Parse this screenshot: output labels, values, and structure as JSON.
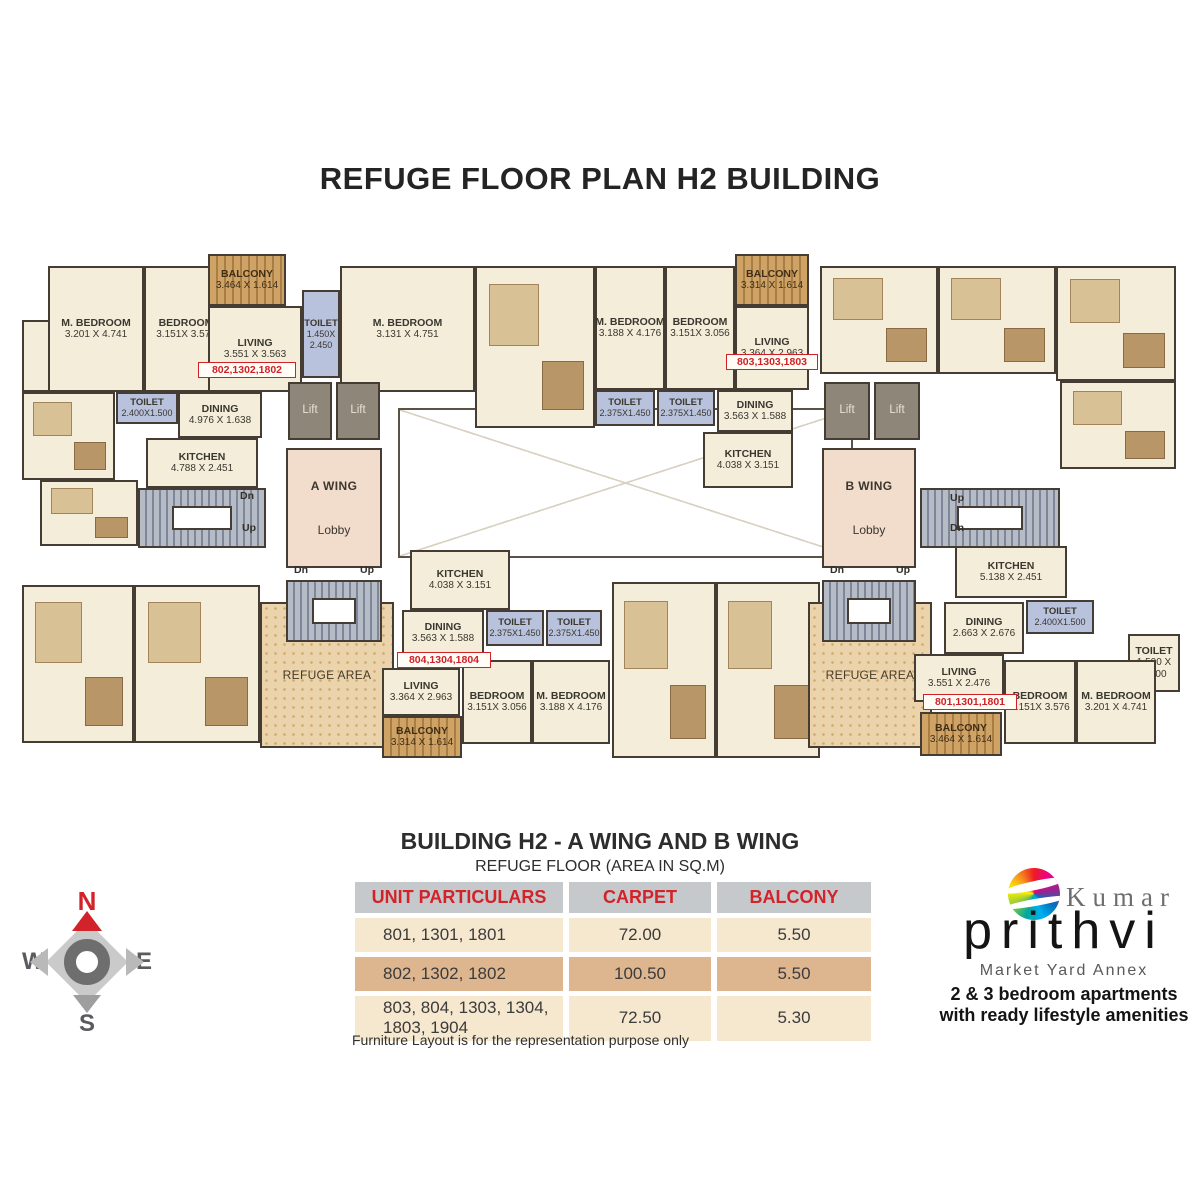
{
  "title": "REFUGE FLOOR PLAN H2 BUILDING",
  "colors": {
    "accent_red": "#d2232a",
    "wall_brown": "#453c33",
    "room_cream": "#f3edda",
    "toilet_blue": "#b9c2dc",
    "balcony_wood": "#c79b5e",
    "lobby_pink": "#f2dccb",
    "refuge_tan": "#ebd4ab",
    "lift_gray": "#8d8679",
    "table_header_gray": "#c6c9cc",
    "table_row_light": "#f6e7cf",
    "table_row_dark": "#ddb68f"
  },
  "plan": {
    "rooms": [
      {
        "id": "void-center",
        "type": "void",
        "lines": [],
        "x": 378,
        "y": 158,
        "w": 455,
        "h": 150
      },
      {
        "id": "block-top-center-left",
        "type": "furnished",
        "lines": [],
        "x": 455,
        "y": 16,
        "w": 120,
        "h": 162
      },
      {
        "id": "block-top-right-1",
        "type": "furnished",
        "lines": [],
        "x": 800,
        "y": 16,
        "w": 118,
        "h": 108
      },
      {
        "id": "block-top-right-2",
        "type": "furnished",
        "lines": [],
        "x": 918,
        "y": 16,
        "w": 118,
        "h": 108
      },
      {
        "id": "block-top-right-3",
        "type": "furnished",
        "lines": [],
        "x": 1036,
        "y": 16,
        "w": 120,
        "h": 115
      },
      {
        "id": "block-right-mid",
        "type": "furnished",
        "lines": [],
        "x": 1040,
        "y": 131,
        "w": 116,
        "h": 88
      },
      {
        "id": "block-bottom-left-1",
        "type": "furnished",
        "lines": [],
        "x": 2,
        "y": 335,
        "w": 112,
        "h": 158
      },
      {
        "id": "block-bottom-left-2",
        "type": "furnished",
        "lines": [],
        "x": 114,
        "y": 335,
        "w": 126,
        "h": 158
      },
      {
        "id": "block-left-entry",
        "type": "furnished",
        "lines": [],
        "x": 2,
        "y": 142,
        "w": 93,
        "h": 88
      },
      {
        "id": "block-left-of-stair",
        "type": "furnished",
        "lines": [],
        "x": 20,
        "y": 230,
        "w": 98,
        "h": 66
      },
      {
        "id": "block-bottom-center-1",
        "type": "furnished",
        "lines": [],
        "x": 592,
        "y": 332,
        "w": 104,
        "h": 176
      },
      {
        "id": "block-bottom-center-2",
        "type": "furnished",
        "lines": [],
        "x": 696,
        "y": 332,
        "w": 104,
        "h": 176
      },
      {
        "id": "toilet-entry-802",
        "type": "room",
        "lines": [
          "TOILET",
          "1.500 X",
          "2.400"
        ],
        "x": 2,
        "y": 70,
        "w": 93,
        "h": 72
      },
      {
        "id": "m-bedroom-802",
        "type": "room",
        "lines": [
          "M. BEDROOM",
          "3.201 X 4.741"
        ],
        "x": 28,
        "y": 16,
        "w": 96,
        "h": 126
      },
      {
        "id": "bedroom-802",
        "type": "room",
        "lines": [
          "BEDROOM",
          "3.151X 3.576"
        ],
        "x": 124,
        "y": 16,
        "w": 84,
        "h": 126
      },
      {
        "id": "balcony-802",
        "type": "balcony",
        "lines": [
          "BALCONY",
          "3.464 X 1.614"
        ],
        "x": 188,
        "y": 4,
        "w": 78,
        "h": 52
      },
      {
        "id": "living-802",
        "type": "room",
        "lines": [
          "LIVING",
          "3.551 X 3.563"
        ],
        "x": 188,
        "y": 56,
        "w": 94,
        "h": 86
      },
      {
        "id": "toilet-802-attached",
        "type": "toilet",
        "lines": [
          "TOILET",
          "1.450X",
          "2.450"
        ],
        "x": 282,
        "y": 40,
        "w": 38,
        "h": 88
      },
      {
        "id": "m-bedroom-802-second",
        "type": "room",
        "lines": [
          "M. BEDROOM",
          "3.131 X 4.751"
        ],
        "x": 320,
        "y": 16,
        "w": 135,
        "h": 126
      },
      {
        "id": "toilet-802-common",
        "type": "toilet",
        "lines": [
          "TOILET",
          "2.400X1.500"
        ],
        "x": 96,
        "y": 142,
        "w": 62,
        "h": 32
      },
      {
        "id": "dining-802",
        "type": "room",
        "lines": [
          "DINING",
          "4.976 X 1.638"
        ],
        "x": 158,
        "y": 142,
        "w": 84,
        "h": 46
      },
      {
        "id": "kitchen-802",
        "type": "room",
        "lines": [
          "KITCHEN",
          "4.788 X 2.451"
        ],
        "x": 126,
        "y": 188,
        "w": 112,
        "h": 50
      },
      {
        "id": "refuge-area-a",
        "type": "refuge",
        "lines": [
          "REFUGE AREA"
        ],
        "x": 240,
        "y": 352,
        "w": 134,
        "h": 146
      },
      {
        "id": "lift-a-1",
        "type": "lift",
        "lines": [
          "Lift"
        ],
        "x": 268,
        "y": 132,
        "w": 44,
        "h": 58
      },
      {
        "id": "lift-a-2",
        "type": "lift",
        "lines": [
          "Lift"
        ],
        "x": 316,
        "y": 132,
        "w": 44,
        "h": 58
      },
      {
        "id": "lobby-a-wing",
        "type": "lobby",
        "lines": [
          "A WING",
          "Lobby"
        ],
        "x": 266,
        "y": 198,
        "w": 96,
        "h": 120
      },
      {
        "id": "stair-a-left",
        "type": "stair",
        "lines": [],
        "x": 118,
        "y": 238,
        "w": 128,
        "h": 60
      },
      {
        "id": "stair-a-mid",
        "type": "stair",
        "lines": [],
        "x": 266,
        "y": 330,
        "w": 96,
        "h": 62
      },
      {
        "id": "m-bedroom-803",
        "type": "room",
        "lines": [
          "M. BEDROOM",
          "3.188 X 4.176"
        ],
        "x": 575,
        "y": 16,
        "w": 70,
        "h": 124
      },
      {
        "id": "bedroom-803",
        "type": "room",
        "lines": [
          "BEDROOM",
          "3.151X 3.056"
        ],
        "x": 645,
        "y": 16,
        "w": 70,
        "h": 124
      },
      {
        "id": "balcony-803",
        "type": "balcony",
        "lines": [
          "BALCONY",
          "3.314 X 1.614"
        ],
        "x": 715,
        "y": 4,
        "w": 74,
        "h": 52
      },
      {
        "id": "living-803",
        "type": "room",
        "lines": [
          "LIVING",
          "3.364 X 2.963"
        ],
        "x": 715,
        "y": 56,
        "w": 74,
        "h": 84
      },
      {
        "id": "toilet-803-a",
        "type": "toilet",
        "lines": [
          "TOILET",
          "2.375X1.450"
        ],
        "x": 575,
        "y": 140,
        "w": 60,
        "h": 36
      },
      {
        "id": "toilet-803-b",
        "type": "toilet",
        "lines": [
          "TOILET",
          "2.375X1.450"
        ],
        "x": 637,
        "y": 140,
        "w": 58,
        "h": 36
      },
      {
        "id": "dining-803",
        "type": "room",
        "lines": [
          "DINING",
          "3.563 X 1.588"
        ],
        "x": 697,
        "y": 140,
        "w": 76,
        "h": 42
      },
      {
        "id": "kitchen-803",
        "type": "room",
        "lines": [
          "KITCHEN",
          "4.038 X 3.151"
        ],
        "x": 683,
        "y": 182,
        "w": 90,
        "h": 56
      },
      {
        "id": "refuge-area-b",
        "type": "refuge",
        "lines": [
          "REFUGE AREA"
        ],
        "x": 788,
        "y": 352,
        "w": 124,
        "h": 146
      },
      {
        "id": "lift-b-1",
        "type": "lift",
        "lines": [
          "Lift"
        ],
        "x": 804,
        "y": 132,
        "w": 46,
        "h": 58
      },
      {
        "id": "lift-b-2",
        "type": "lift",
        "lines": [
          "Lift"
        ],
        "x": 854,
        "y": 132,
        "w": 46,
        "h": 58
      },
      {
        "id": "lobby-b-wing",
        "type": "lobby",
        "lines": [
          "B WING",
          "Lobby"
        ],
        "x": 802,
        "y": 198,
        "w": 94,
        "h": 120
      },
      {
        "id": "stair-b-right",
        "type": "stair",
        "lines": [],
        "x": 900,
        "y": 238,
        "w": 140,
        "h": 60
      },
      {
        "id": "stair-b-mid",
        "type": "stair",
        "lines": [],
        "x": 802,
        "y": 330,
        "w": 94,
        "h": 62
      },
      {
        "id": "kitchen-804",
        "type": "room",
        "lines": [
          "KITCHEN",
          "4.038 X 3.151"
        ],
        "x": 390,
        "y": 300,
        "w": 100,
        "h": 60
      },
      {
        "id": "dining-804",
        "type": "room",
        "lines": [
          "DINING",
          "3.563 X 1.588"
        ],
        "x": 382,
        "y": 360,
        "w": 82,
        "h": 46
      },
      {
        "id": "toilet-804-a",
        "type": "toilet",
        "lines": [
          "TOILET",
          "2.375X1.450"
        ],
        "x": 466,
        "y": 360,
        "w": 58,
        "h": 36
      },
      {
        "id": "toilet-804-b",
        "type": "toilet",
        "lines": [
          "TOILET",
          "2.375X1.450"
        ],
        "x": 526,
        "y": 360,
        "w": 56,
        "h": 36
      },
      {
        "id": "living-804",
        "type": "room",
        "lines": [
          "LIVING",
          "3.364 X 2.963"
        ],
        "x": 362,
        "y": 418,
        "w": 78,
        "h": 48
      },
      {
        "id": "balcony-804",
        "type": "balcony",
        "lines": [
          "BALCONY",
          "3.314 X 1.614"
        ],
        "x": 362,
        "y": 466,
        "w": 80,
        "h": 42
      },
      {
        "id": "bedroom-804",
        "type": "room",
        "lines": [
          "BEDROOM",
          "3.151X 3.056"
        ],
        "x": 442,
        "y": 410,
        "w": 70,
        "h": 84
      },
      {
        "id": "m-bedroom-804",
        "type": "room",
        "lines": [
          "M. BEDROOM",
          "3.188 X 4.176"
        ],
        "x": 512,
        "y": 410,
        "w": 78,
        "h": 84
      },
      {
        "id": "kitchen-801",
        "type": "room",
        "lines": [
          "KITCHEN",
          "5.138 X 2.451"
        ],
        "x": 935,
        "y": 296,
        "w": 112,
        "h": 52
      },
      {
        "id": "toilet-801-common",
        "type": "toilet",
        "lines": [
          "TOILET",
          "2.400X1.500"
        ],
        "x": 1006,
        "y": 350,
        "w": 68,
        "h": 34
      },
      {
        "id": "dining-801",
        "type": "room",
        "lines": [
          "DINING",
          "2.663 X 2.676"
        ],
        "x": 924,
        "y": 352,
        "w": 80,
        "h": 52
      },
      {
        "id": "toilet-801-end",
        "type": "room",
        "lines": [
          "TOILET",
          "1.500 X",
          "2.400"
        ],
        "x": 1108,
        "y": 384,
        "w": 52,
        "h": 58
      },
      {
        "id": "living-801",
        "type": "room",
        "lines": [
          "LIVING",
          "3.551 X 2.476"
        ],
        "x": 894,
        "y": 404,
        "w": 90,
        "h": 48
      },
      {
        "id": "balcony-801",
        "type": "balcony",
        "lines": [
          "BALCONY",
          "3.464 X 1.614"
        ],
        "x": 900,
        "y": 462,
        "w": 82,
        "h": 44
      },
      {
        "id": "bedroom-801",
        "type": "room",
        "lines": [
          "BEDROOM",
          "3.151X 3.576"
        ],
        "x": 984,
        "y": 410,
        "w": 72,
        "h": 84
      },
      {
        "id": "m-bedroom-801",
        "type": "room",
        "lines": [
          "M. BEDROOM",
          "3.201 X 4.741"
        ],
        "x": 1056,
        "y": 410,
        "w": 80,
        "h": 84
      }
    ],
    "unit_tags": [
      {
        "id": "unit-tag-802",
        "text": "802,1302,1802",
        "x": 178,
        "y": 112,
        "w": 98,
        "h": 16
      },
      {
        "id": "unit-tag-803",
        "text": "803,1303,1803",
        "x": 706,
        "y": 104,
        "w": 92,
        "h": 16
      },
      {
        "id": "unit-tag-804",
        "text": "804,1304,1804",
        "x": 377,
        "y": 402,
        "w": 94,
        "h": 16
      },
      {
        "id": "unit-tag-801",
        "text": "801,1301,1801",
        "x": 903,
        "y": 444,
        "w": 94,
        "h": 16
      }
    ],
    "stair_labels": [
      {
        "text": "Dn",
        "x": 220,
        "y": 240
      },
      {
        "text": "Up",
        "x": 222,
        "y": 272
      },
      {
        "text": "Dn",
        "x": 274,
        "y": 314
      },
      {
        "text": "Up",
        "x": 340,
        "y": 314
      },
      {
        "text": "Up",
        "x": 930,
        "y": 242
      },
      {
        "text": "Dn",
        "x": 930,
        "y": 272
      },
      {
        "text": "Dn",
        "x": 810,
        "y": 314
      },
      {
        "text": "Up",
        "x": 876,
        "y": 314
      }
    ]
  },
  "summary": {
    "heading": "BUILDING H2 - A WING AND B WING",
    "subheading": "REFUGE FLOOR (AREA IN SQ.M)",
    "footnote": "Furniture Layout is for the representation purpose only",
    "table": {
      "headers": [
        "UNIT PARTICULARS",
        "CARPET",
        "BALCONY"
      ],
      "rows": [
        {
          "units": "801, 1301, 1801",
          "carpet": "72.00",
          "balcony": "5.50",
          "shade": "light"
        },
        {
          "units": "802, 1302, 1802",
          "carpet": "100.50",
          "balcony": "5.50",
          "shade": "dark"
        },
        {
          "units": "803, 804, 1303, 1304,\n1803, 1904",
          "carpet": "72.50",
          "balcony": "5.30",
          "shade": "light"
        }
      ]
    }
  },
  "compass": {
    "north": "N",
    "south": "S",
    "east": "E",
    "west": "W"
  },
  "logo": {
    "brand_top": "Kumar",
    "brand": "prithvi",
    "location": "Market Yard Annex",
    "tagline_line1": "2 & 3 bedroom apartments",
    "tagline_line2": "with ready lifestyle amenities"
  }
}
